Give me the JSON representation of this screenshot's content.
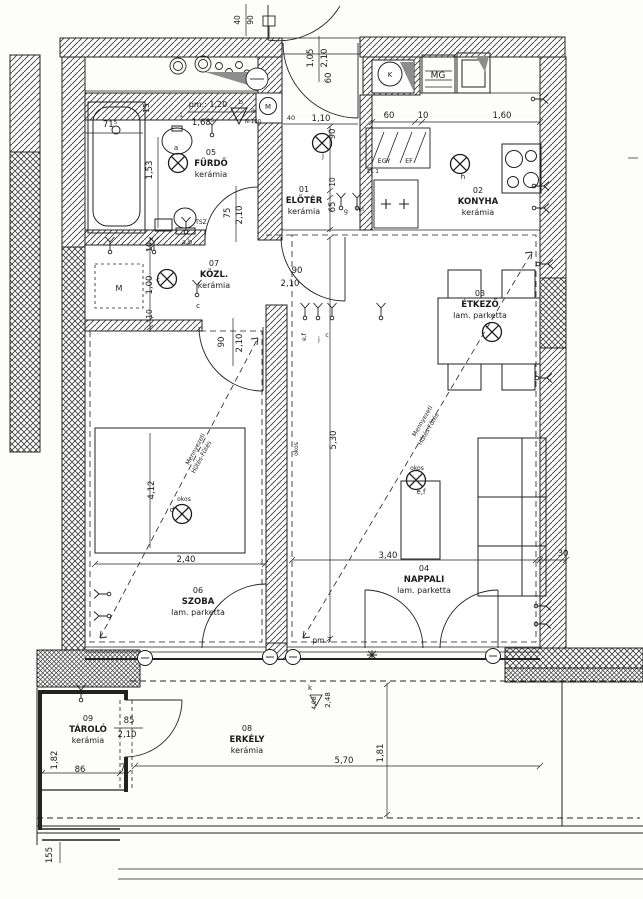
{
  "plan": {
    "ink": "#1b1b1b",
    "rooms": [
      {
        "num": "05",
        "name": "FÜRDŐ",
        "floor": "kerámia",
        "x": 211,
        "y": 155
      },
      {
        "num": "01",
        "name": "ELŐTÉR",
        "floor": "kerámia",
        "x": 304,
        "y": 192
      },
      {
        "num": "02",
        "name": "KONYHA",
        "floor": "kerámia",
        "x": 478,
        "y": 193
      },
      {
        "num": "07",
        "name": "KÖZL.",
        "floor": "kerámia",
        "x": 214,
        "y": 266
      },
      {
        "num": "03",
        "name": "ÉTKEZŐ",
        "floor": "lam. parketta",
        "x": 480,
        "y": 296
      },
      {
        "num": "06",
        "name": "SZOBA",
        "floor": "lam. parketta",
        "x": 198,
        "y": 593
      },
      {
        "num": "04",
        "name": "NAPPALI",
        "floor": "lam. parketta",
        "x": 424,
        "y": 571
      },
      {
        "num": "09",
        "name": "TÁROLÓ",
        "floor": "kerámia",
        "x": 88,
        "y": 721
      },
      {
        "num": "08",
        "name": "ERKÉLY",
        "floor": "kerámia",
        "x": 247,
        "y": 731
      }
    ],
    "labels": [
      {
        "t": "71⁵",
        "x": 110,
        "y": 127
      },
      {
        "t": "pm.: 1,20",
        "x": 208,
        "y": 107,
        "s": 8
      },
      {
        "t": "1,68⁵",
        "x": 203,
        "y": 125
      },
      {
        "t": "15",
        "x": 149,
        "y": 108,
        "r": -90,
        "s": 7.5
      },
      {
        "t": "1,53",
        "x": 152,
        "y": 170,
        "r": -90
      },
      {
        "t": "75",
        "x": 230,
        "y": 213,
        "r": -90
      },
      {
        "t": "2,10",
        "x": 242,
        "y": 215,
        "r": -90
      },
      {
        "t": "TSZ",
        "x": 201,
        "y": 224,
        "s": 6
      },
      {
        "t": "N-100",
        "x": 253,
        "y": 123,
        "s": 5.5
      },
      {
        "t": "a",
        "x": 176,
        "y": 150,
        "s": 7
      },
      {
        "t": "1",
        "x": 181,
        "y": 117,
        "s": 6
      },
      {
        "t": "b",
        "x": 241,
        "y": 104,
        "s": 6.5
      },
      {
        "t": "a",
        "x": 253,
        "y": 112,
        "s": 6.5
      },
      {
        "t": "40",
        "x": 291,
        "y": 120,
        "s": 6.5
      },
      {
        "t": "40",
        "x": 240,
        "y": 20,
        "r": -90,
        "s": 7.5
      },
      {
        "t": "90",
        "x": 253,
        "y": 20,
        "r": -90,
        "s": 7.5
      },
      {
        "t": "1,05",
        "x": 313,
        "y": 58,
        "r": -90
      },
      {
        "t": "2,10",
        "x": 327,
        "y": 58,
        "r": -90
      },
      {
        "t": "60",
        "x": 331,
        "y": 78,
        "r": -90
      },
      {
        "t": "1,10",
        "x": 321,
        "y": 121
      },
      {
        "t": "90",
        "x": 335,
        "y": 134,
        "r": -90
      },
      {
        "t": "10",
        "x": 335,
        "y": 182,
        "r": -90,
        "s": 7.5
      },
      {
        "t": "65",
        "x": 335,
        "y": 207,
        "r": -90
      },
      {
        "t": "g",
        "x": 346,
        "y": 213,
        "s": 6.5
      },
      {
        "t": "h,i",
        "x": 360,
        "y": 211,
        "s": 6.5
      },
      {
        "t": "j",
        "x": 323,
        "y": 158,
        "s": 7
      },
      {
        "t": "EGY",
        "x": 384,
        "y": 163,
        "s": 6.5
      },
      {
        "t": "EF",
        "x": 409,
        "y": 163,
        "s": 6.5
      },
      {
        "t": "EL 1",
        "x": 373,
        "y": 173,
        "s": 5.5
      },
      {
        "t": "60",
        "x": 389,
        "y": 118
      },
      {
        "t": "10",
        "x": 423,
        "y": 118
      },
      {
        "t": "1,60",
        "x": 502,
        "y": 118
      },
      {
        "t": "h",
        "x": 463,
        "y": 179,
        "s": 7
      },
      {
        "t": "90",
        "x": 297,
        "y": 273
      },
      {
        "t": "M",
        "x": 268,
        "y": 109,
        "s": 7
      },
      {
        "t": "MG",
        "x": 438,
        "y": 78,
        "s": 9
      },
      {
        "t": "K",
        "x": 390,
        "y": 77,
        "s": 7
      },
      {
        "t": "a,b",
        "x": 187,
        "y": 244,
        "s": 6.5
      },
      {
        "t": "c",
        "x": 158,
        "y": 282,
        "s": 7
      },
      {
        "t": "10",
        "x": 152,
        "y": 247,
        "r": -90,
        "s": 7.5
      },
      {
        "t": "1,00",
        "x": 152,
        "y": 285,
        "r": -90
      },
      {
        "t": "10",
        "x": 152,
        "y": 314,
        "r": -90,
        "s": 7.5
      },
      {
        "t": "M",
        "x": 119,
        "y": 291,
        "s": 8
      },
      {
        "t": "c",
        "x": 198,
        "y": 308,
        "s": 7
      },
      {
        "t": "90",
        "x": 224,
        "y": 342,
        "r": -90
      },
      {
        "t": "2,10",
        "x": 242,
        "y": 343,
        "r": -90
      },
      {
        "t": "2,10",
        "x": 290,
        "y": 286
      },
      {
        "t": "e,f",
        "x": 306,
        "y": 337,
        "r": -90,
        "s": 6
      },
      {
        "t": "j",
        "x": 319,
        "y": 341,
        "s": 6
      },
      {
        "t": "c",
        "x": 327,
        "y": 337,
        "s": 6
      },
      {
        "t": "okos",
        "x": 298,
        "y": 449,
        "r": -90,
        "s": 6
      },
      {
        "t": "5,30",
        "x": 336,
        "y": 440,
        "r": -90
      },
      {
        "t": "4,12",
        "x": 154,
        "y": 490,
        "r": -90
      },
      {
        "t": "okos",
        "x": 184,
        "y": 501,
        "s": 6
      },
      {
        "t": "d",
        "x": 172,
        "y": 512,
        "s": 7
      },
      {
        "t": "okos",
        "x": 417,
        "y": 470,
        "s": 6
      },
      {
        "t": "e,f",
        "x": 421,
        "y": 494,
        "s": 7
      },
      {
        "t": "2,40",
        "x": 186,
        "y": 562
      },
      {
        "t": "3,40",
        "x": 388,
        "y": 558
      },
      {
        "t": "30",
        "x": 563,
        "y": 556
      },
      {
        "t": "pm 7",
        "x": 322,
        "y": 643,
        "s": 7.5
      },
      {
        "t": "k",
        "x": 310,
        "y": 690,
        "s": 7
      },
      {
        "t": "4,08",
        "x": 316,
        "y": 703,
        "r": -90,
        "s": 6
      },
      {
        "t": "2,48",
        "x": 330,
        "y": 700,
        "r": -90,
        "s": 7
      },
      {
        "t": "5,70",
        "x": 344,
        "y": 763
      },
      {
        "t": "1,81",
        "x": 383,
        "y": 753,
        "r": -90
      },
      {
        "t": "1,82",
        "x": 57,
        "y": 760,
        "r": -90
      },
      {
        "t": "86",
        "x": 80,
        "y": 772
      },
      {
        "t": "7",
        "x": 123,
        "y": 770
      },
      {
        "t": "85",
        "x": 129,
        "y": 723
      },
      {
        "t": "2,10",
        "x": 127,
        "y": 737
      },
      {
        "t": "155",
        "x": 52,
        "y": 855,
        "r": -90
      }
    ],
    "heating_notes": [
      {
        "l1": "Mennyezeti",
        "l2": "Hűtés-Fűtés",
        "x": 197,
        "y": 450,
        "r": -62
      },
      {
        "l1": "Mennyezeti",
        "l2": "Hűtés-Fűtés",
        "x": 424,
        "y": 422,
        "r": -60
      }
    ],
    "lights": [
      {
        "x": 178,
        "y": 163
      },
      {
        "x": 167,
        "y": 279
      },
      {
        "x": 322,
        "y": 143
      },
      {
        "x": 460,
        "y": 164
      },
      {
        "x": 492,
        "y": 332
      },
      {
        "x": 182,
        "y": 514
      },
      {
        "x": 416,
        "y": 480
      }
    ],
    "switches": [
      {
        "x": 186,
        "y": 232,
        "r": 0
      },
      {
        "x": 197,
        "y": 295,
        "r": 0
      },
      {
        "x": 341,
        "y": 208,
        "r": 0
      },
      {
        "x": 357,
        "y": 208,
        "r": 0
      },
      {
        "x": 305,
        "y": 318,
        "r": 0
      },
      {
        "x": 318,
        "y": 318,
        "r": 0
      },
      {
        "x": 332,
        "y": 318,
        "r": 0
      },
      {
        "x": 533,
        "y": 99,
        "r": 90
      },
      {
        "x": 534,
        "y": 186,
        "r": 90
      },
      {
        "x": 534,
        "y": 208,
        "r": 90
      },
      {
        "x": 538,
        "y": 264,
        "r": 90
      },
      {
        "x": 537,
        "y": 378,
        "r": 90
      },
      {
        "x": 536,
        "y": 606,
        "r": 90
      },
      {
        "x": 536,
        "y": 624,
        "r": 90
      },
      {
        "x": 109,
        "y": 594,
        "r": -90
      },
      {
        "x": 109,
        "y": 616,
        "r": -90
      },
      {
        "x": 81,
        "y": 700,
        "r": 0
      },
      {
        "x": 110,
        "y": 252,
        "r": 0
      },
      {
        "x": 154,
        "y": 252,
        "r": 0
      },
      {
        "x": 381,
        "y": 318,
        "r": 0
      },
      {
        "x": 212,
        "y": 135,
        "r": 0
      }
    ],
    "wall_markers": [
      {
        "x": 145,
        "y": 658
      },
      {
        "x": 270,
        "y": 657
      },
      {
        "x": 293,
        "y": 657
      },
      {
        "x": 493,
        "y": 656
      }
    ]
  }
}
